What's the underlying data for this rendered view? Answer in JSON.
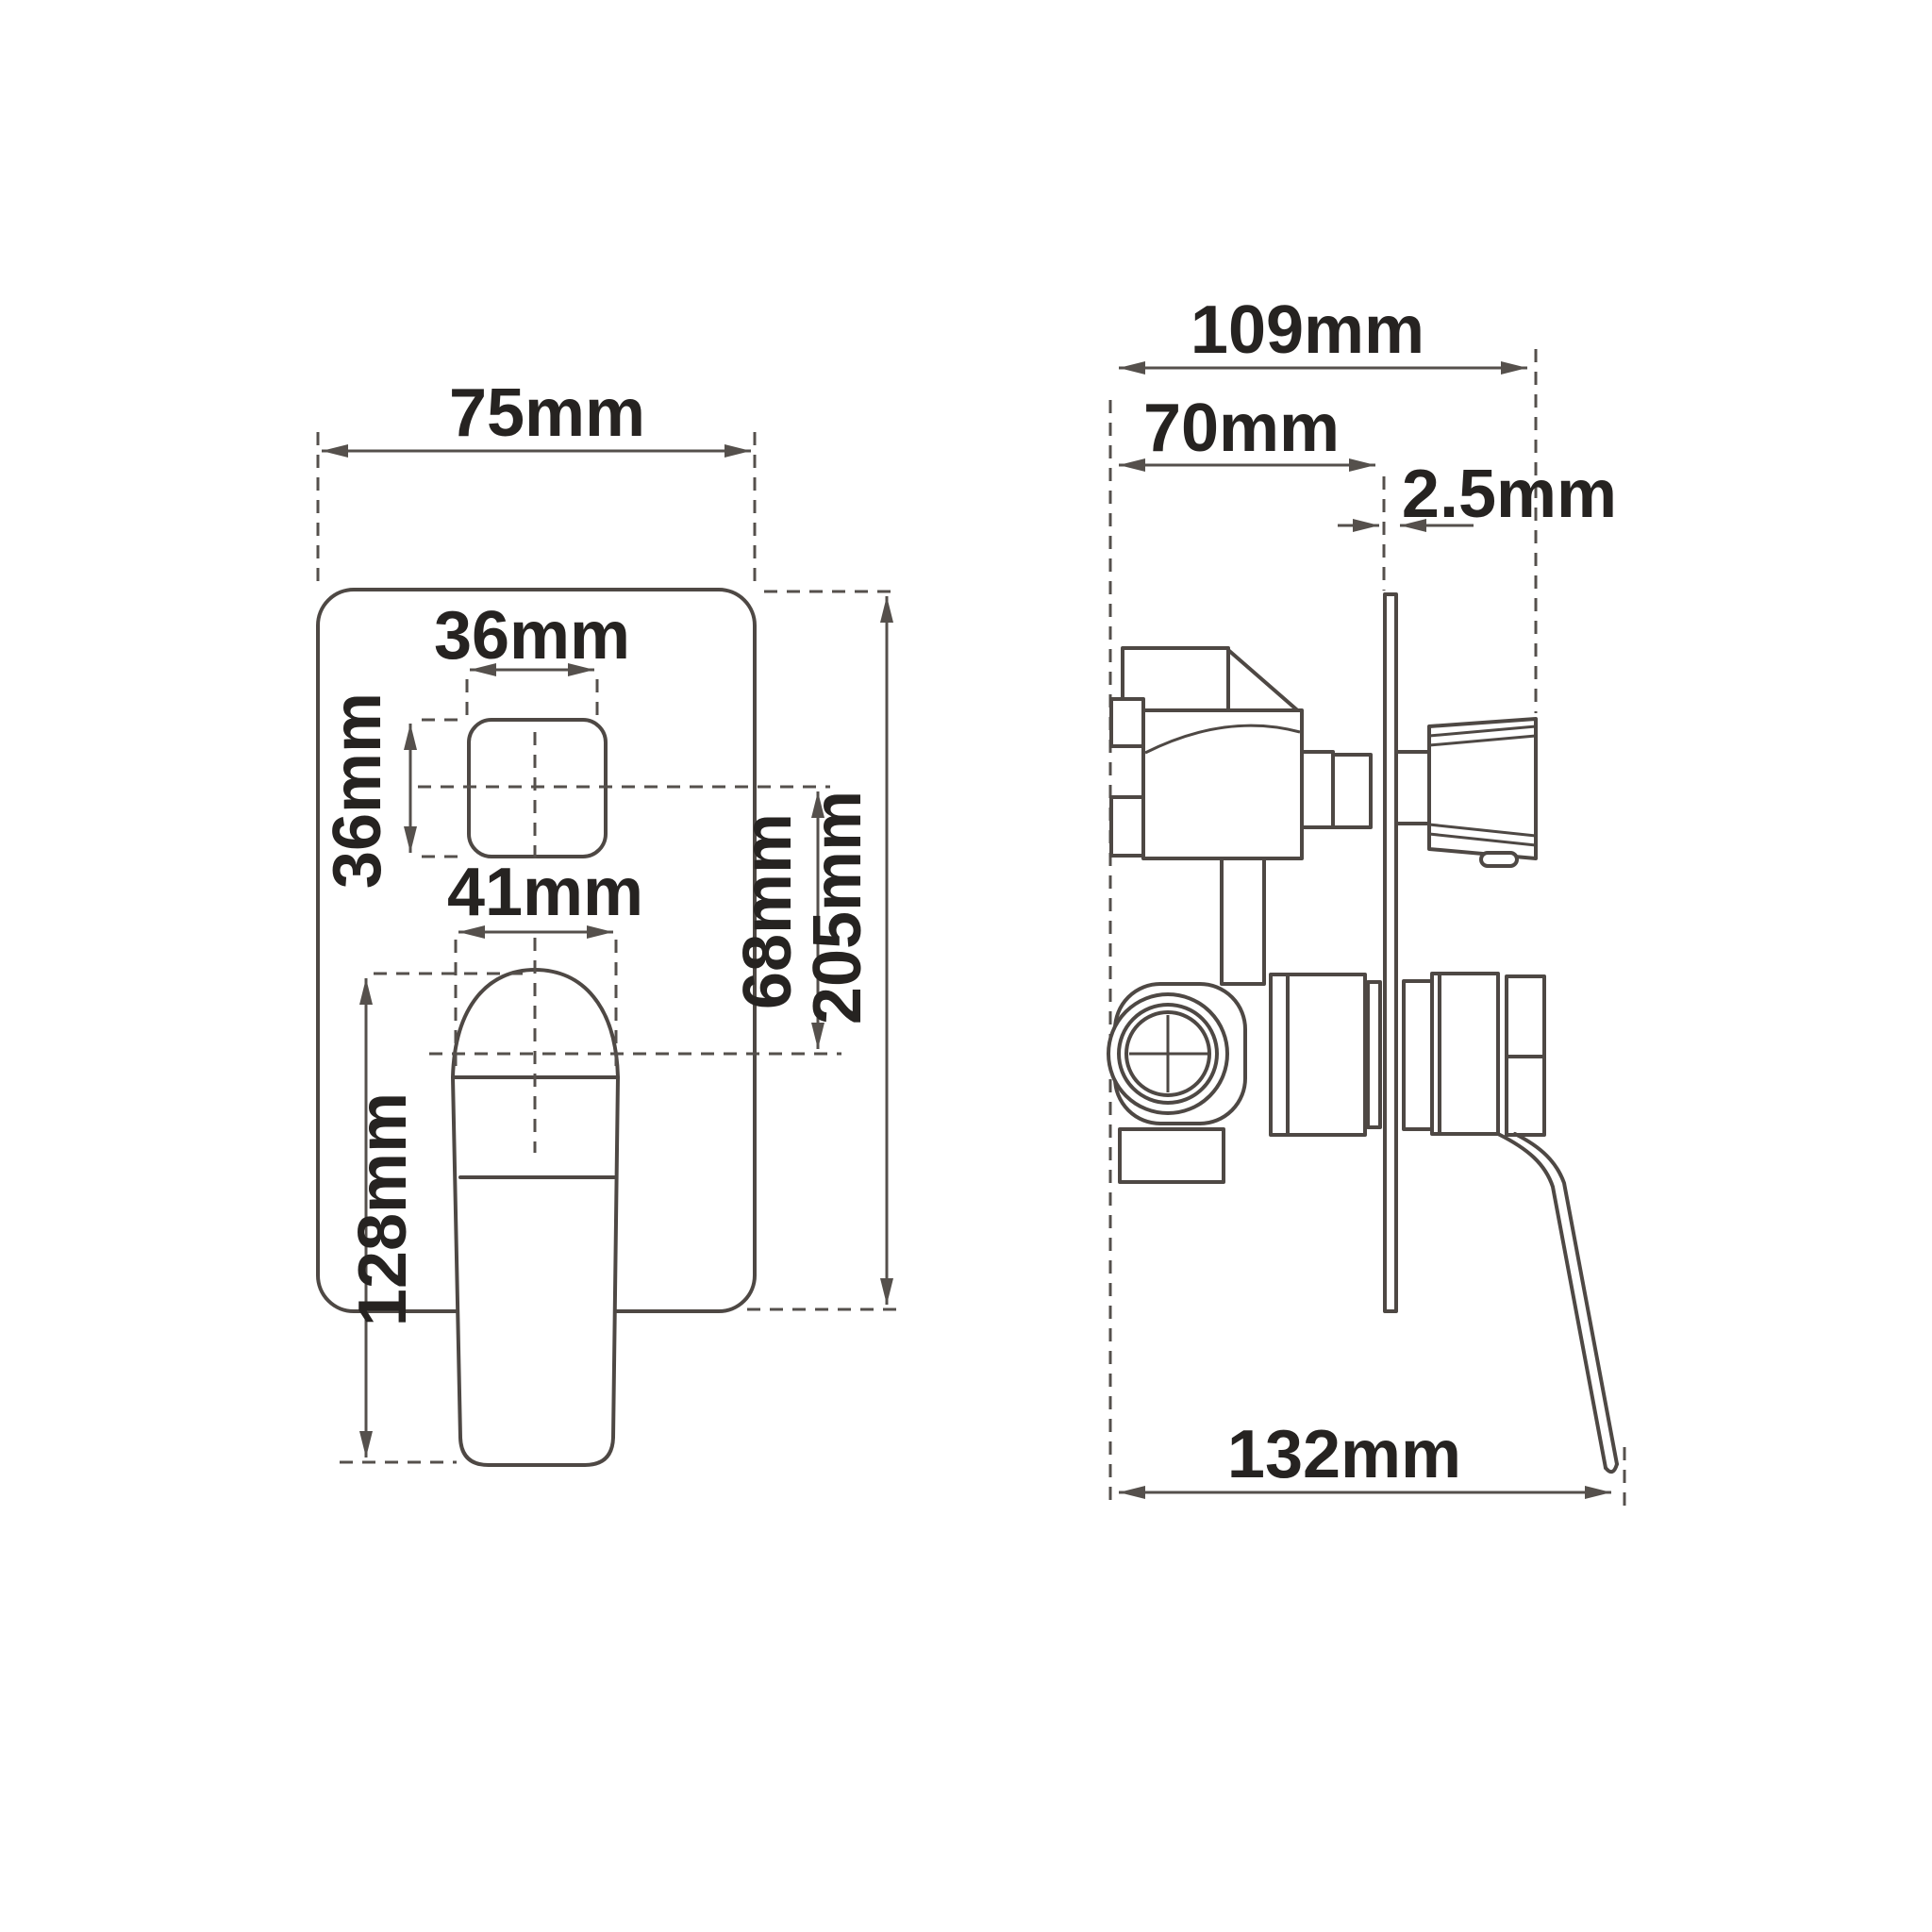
{
  "drawing_type": "technical dimension drawing - concealed shower mixer valve, front and side views",
  "unit": "mm",
  "front_view": {
    "plate_width": "75mm",
    "button_width": "36mm",
    "button_height": "36mm",
    "handle_width": "41mm",
    "handle_length": "128mm",
    "button_to_handle_center": "68mm",
    "plate_height": "205mm"
  },
  "side_view": {
    "overall_depth": "109mm",
    "valve_body_depth": "70mm",
    "plate_thickness": "2.5mm",
    "total_projection": "132mm"
  },
  "colors": {
    "line": "#4e4844",
    "dimension_line": "#55504c",
    "text": "#262321",
    "background": "#ffffff"
  }
}
